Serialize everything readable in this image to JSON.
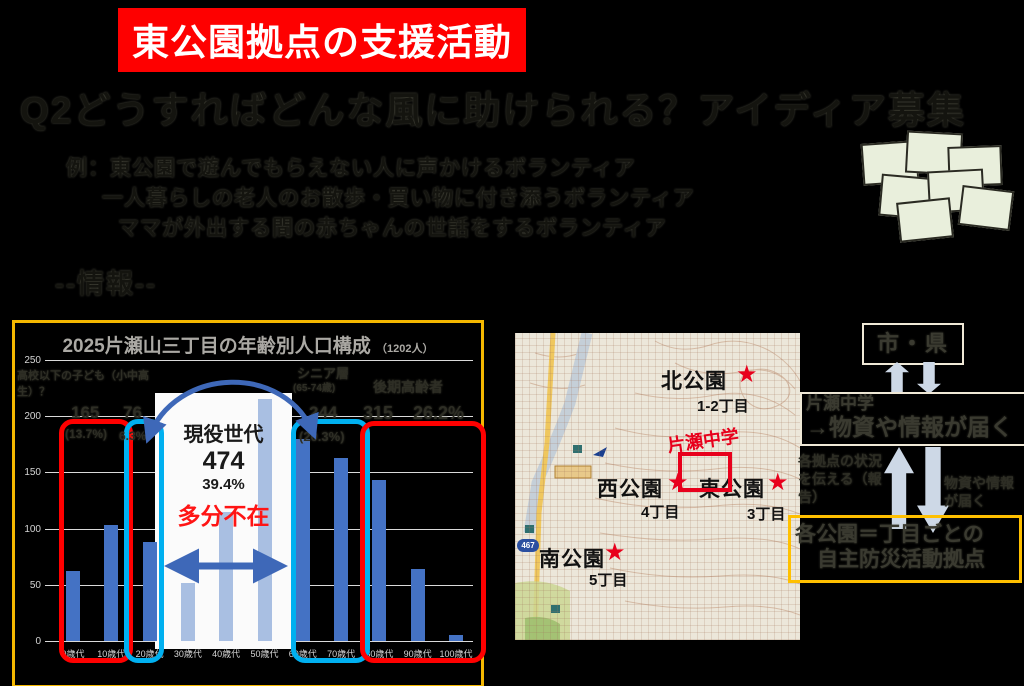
{
  "slide": {
    "banner": "東公園拠点の支援活動",
    "heading": "Q2どうすればどんな風に助けられる？アイディア募集",
    "examples": [
      "例：東公園で遊んでもらえない人に声かけるボランティア",
      "一人暮らしの老人のお散歩・買い物に付き添うボランティア",
      "ママが外出する間の赤ちゃんの世話をするボランティア"
    ],
    "section_label": "--情報--"
  },
  "chart_data": {
    "type": "bar",
    "title": "2025片瀬山三丁目の年齢別人口構成",
    "title_suffix": "（1202人）",
    "categories": [
      "0歳代",
      "10歳代",
      "20歳代",
      "30歳代",
      "40歳代",
      "50歳代",
      "60歳代",
      "70歳代",
      "80歳代",
      "90歳代",
      "100歳代"
    ],
    "values": [
      62,
      103,
      88,
      52,
      115,
      215,
      180,
      163,
      143,
      64,
      5
    ],
    "ylim": [
      0,
      250
    ],
    "ytick_step": 50,
    "grid": true,
    "legend": "none",
    "light_bar_indices": [
      3,
      4,
      5
    ],
    "annotations": {
      "kids_label": "高校以下の子ども（小中高生）？",
      "kids_value": "165",
      "kids_pct": "(13.7%)",
      "students_value": "76",
      "students_pct": "6.3%",
      "active_label": "現役世代",
      "active_value": "474",
      "active_pct": "39.4%",
      "active_note": "多分不在",
      "senior_label": "シニア層",
      "senior_sub": "(65-74歳)",
      "senior_value": "244",
      "senior_pct": "(20.3%)",
      "elder_label": "後期高齢者",
      "elder_value": "315",
      "elder_pct": "26.2%"
    }
  },
  "map": {
    "route_shield": "467",
    "school": "片瀬中学",
    "labels": [
      {
        "name": "北公園",
        "sub": "1-2丁目",
        "nx": 146,
        "ny": 32,
        "sx": 221,
        "sy": 30,
        "bx": 182,
        "by": 62
      },
      {
        "name": "西公園",
        "sub": "4丁目",
        "nx": 82,
        "ny": 140,
        "sx": 152,
        "sy": 138,
        "bx": 126,
        "by": 168
      },
      {
        "name": "東公園",
        "sub": "3丁目",
        "nx": 184,
        "ny": 140,
        "sx": 252,
        "sy": 138,
        "bx": 232,
        "by": 170
      },
      {
        "name": "南公園",
        "sub": "5丁目",
        "nx": 24,
        "ny": 210,
        "sx": 89,
        "sy": 208,
        "bx": 74,
        "by": 236
      }
    ]
  },
  "flow": {
    "top_box": "市・県",
    "mid_box_line1": "片瀬中学",
    "mid_box_line2": "→物資や情報が届く",
    "up_label": "各拠点の状況を伝える（報告）",
    "down_label": "物資や情報が届く",
    "bottom_line1": "各公園＝丁目ごとの",
    "bottom_line2": "自主防災活動拠点"
  },
  "decor": {
    "notes": [
      {
        "x": 862,
        "y": 142,
        "w": 52,
        "h": 38,
        "r": -4
      },
      {
        "x": 906,
        "y": 132,
        "w": 52,
        "h": 38,
        "r": 3
      },
      {
        "x": 948,
        "y": 146,
        "w": 50,
        "h": 36,
        "r": -2
      },
      {
        "x": 880,
        "y": 176,
        "w": 52,
        "h": 38,
        "r": 5
      },
      {
        "x": 928,
        "y": 170,
        "w": 52,
        "h": 38,
        "r": -3
      },
      {
        "x": 960,
        "y": 188,
        "w": 48,
        "h": 36,
        "r": 7
      },
      {
        "x": 898,
        "y": 200,
        "w": 50,
        "h": 36,
        "r": -6
      }
    ]
  },
  "colors": {
    "banner_bg": "#FE0000",
    "banner_fg": "#FFFFFF",
    "chart_border": "#F5B800",
    "bar_dark": "#4472C4",
    "bar_light": "#A9BFE2",
    "box_red": "#FF0000",
    "box_cyan": "#00B0F0",
    "arrow_blue": "#3E68B8",
    "map_star": "#E8001C",
    "flow_arrow": "#CDD8E6",
    "flow_yellow": "#FFC000"
  }
}
